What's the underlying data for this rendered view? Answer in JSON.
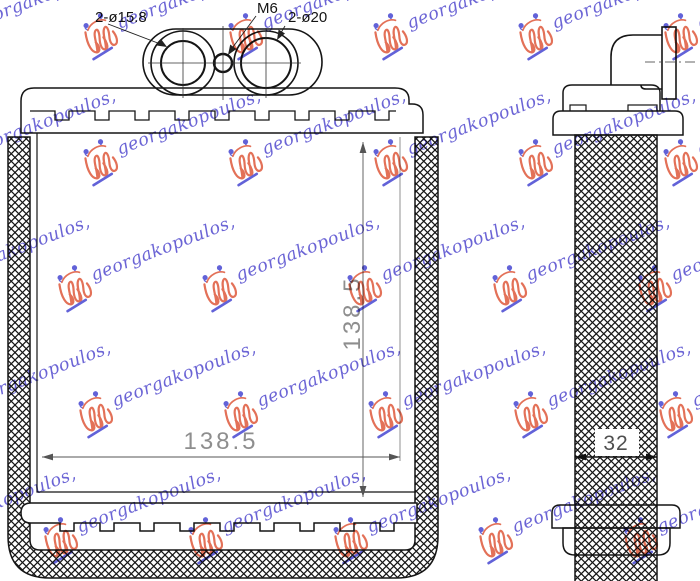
{
  "views": {
    "front": {
      "labels": {
        "port_small": "2-ø15.8",
        "thread": "M6",
        "port_large": "2-ø20"
      },
      "dimensions": {
        "width": "138.5",
        "height": "138.5"
      }
    },
    "side": {
      "dimensions": {
        "depth": "32"
      }
    }
  },
  "watermark": {
    "text": "georgakopoulos,"
  },
  "colors": {
    "line": "#151515",
    "dimension_text": "#8e8e8e",
    "depth_text": "#4f4f4f",
    "watermark_blue": "#4a42cc",
    "watermark_orange": "#dd5233"
  }
}
